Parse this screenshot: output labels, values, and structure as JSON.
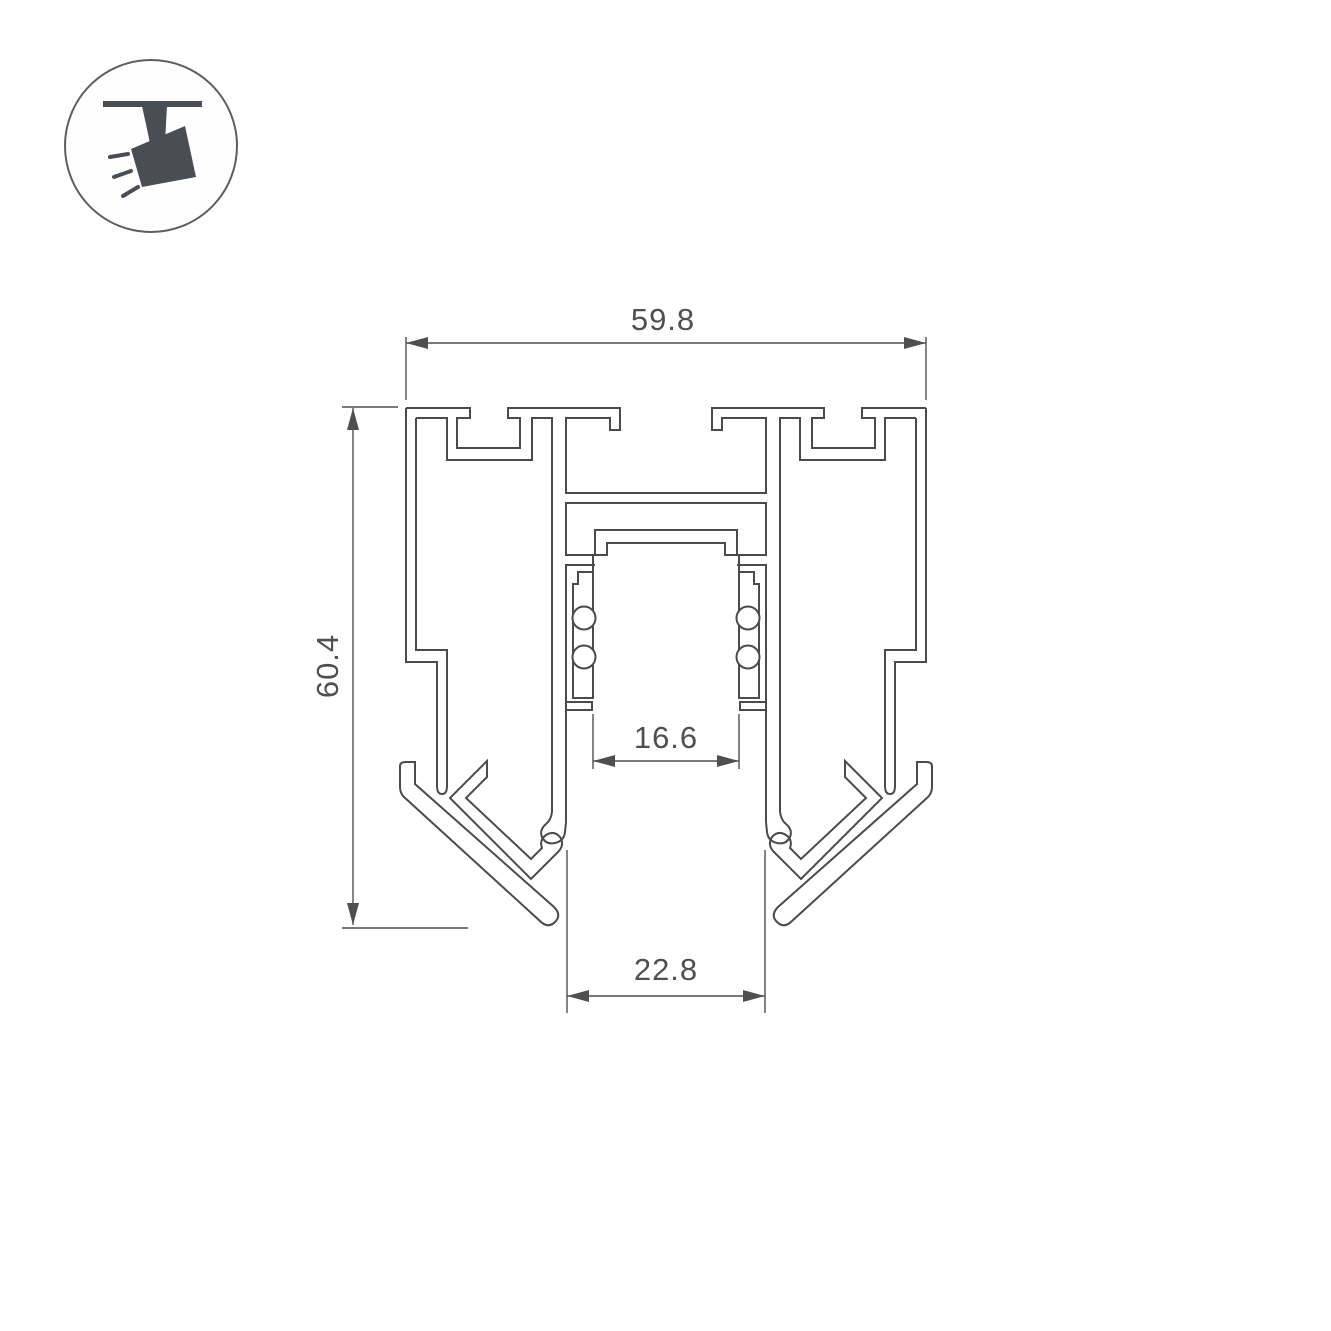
{
  "icon": {
    "name": "ceiling-track-spotlight"
  },
  "drawing": {
    "dimensions": {
      "width_top": "59.8",
      "height_left": "60.4",
      "inner_width": "16.6",
      "bottom_width": "22.8"
    }
  },
  "colors": {
    "line": "#4b4b4b",
    "dimension": "#4f4f4f",
    "icon": "#484e53",
    "background": "#ffffff"
  }
}
